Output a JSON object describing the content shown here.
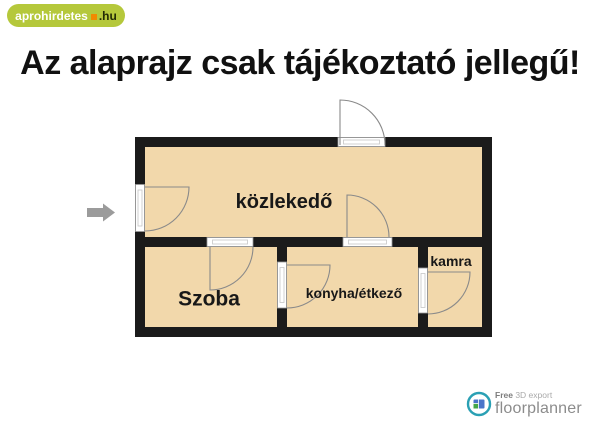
{
  "logo": {
    "text": "aprohirdetes",
    "tld": ".hu"
  },
  "title": "Az alaprajz csak tájékoztató jellegű!",
  "floorplan": {
    "rooms": [
      {
        "name": "közlekedő"
      },
      {
        "name": "Szoba"
      },
      {
        "name": "konyha/étkező"
      },
      {
        "name": "kamra"
      }
    ]
  },
  "watermark": {
    "free": "Free",
    "export": " 3D export",
    "brand": "floorplanner"
  },
  "colors": {
    "logo_green": "#b5c83b",
    "logo_orange": "#f18a00",
    "room_fill": "#f2d8ab",
    "wall": "#1b1b1b",
    "door_frame": "#ffffff",
    "door_line": "#8a8a8a",
    "arrow": "#9b9b9b",
    "watermark_teal": "#2aa0b4"
  }
}
